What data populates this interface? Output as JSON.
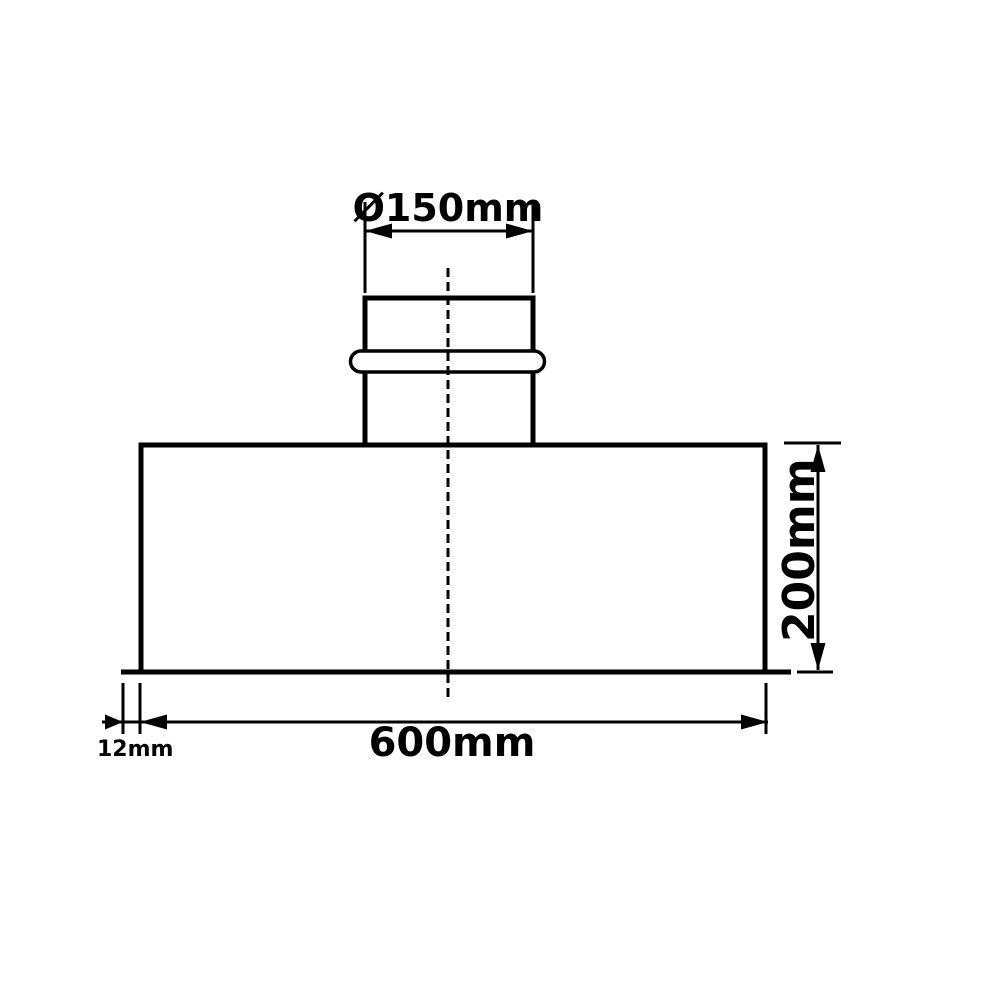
{
  "drawing": {
    "background_color": "#ffffff",
    "line_color": "#000000",
    "part": "duct-plenum-box-with-beaded-spigot",
    "dimensions": {
      "spigot_diameter": {
        "label": "Ø150mm"
      },
      "body_height": {
        "label": "200mm"
      },
      "body_width": {
        "label": "600mm"
      },
      "flange_lip": {
        "label": "12mm"
      }
    }
  }
}
